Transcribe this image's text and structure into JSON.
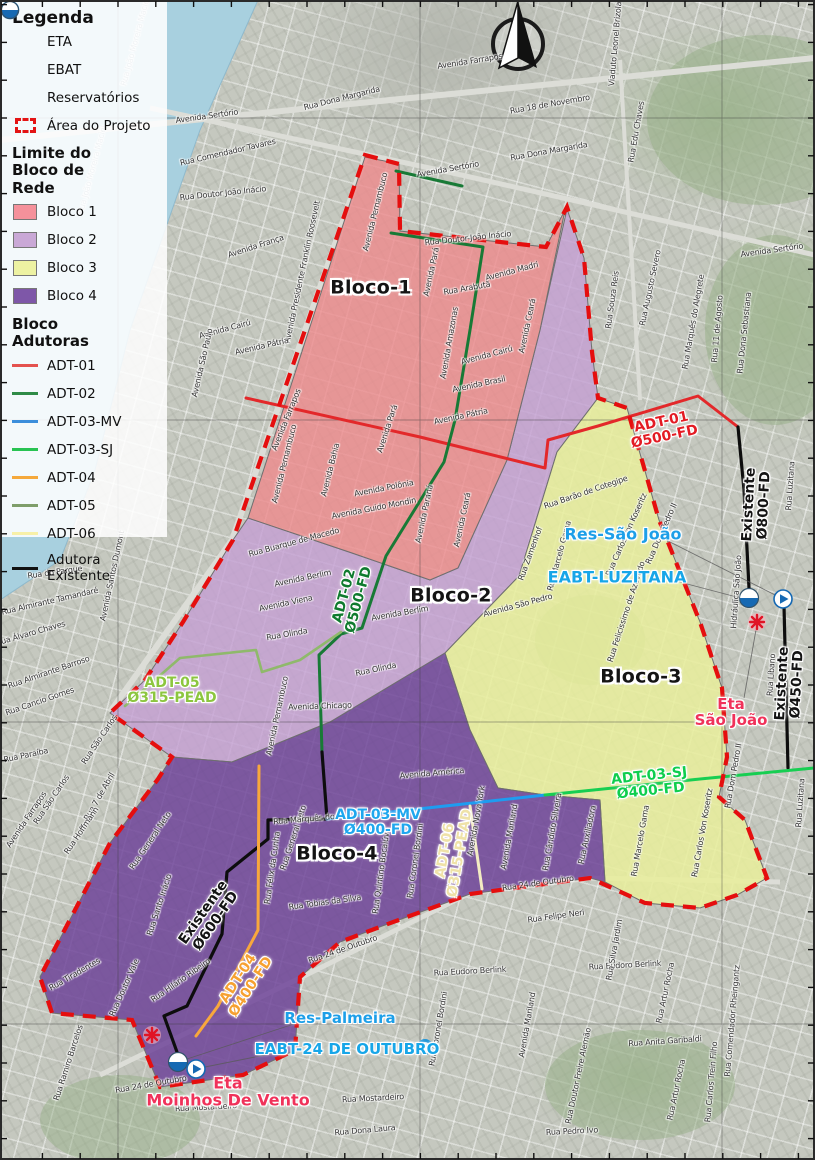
{
  "legend": {
    "title": "Legenda",
    "items": [
      {
        "label": "ETA"
      },
      {
        "label": "EBAT"
      },
      {
        "label": "Reservatórios"
      },
      {
        "label": "Área do Projeto"
      }
    ],
    "limite_title": "Limite do Bloco de Rede",
    "blocks": [
      {
        "label": "Bloco 1",
        "color": "#F5919B"
      },
      {
        "label": "Bloco 2",
        "color": "#C9A8D6"
      },
      {
        "label": "Bloco 3",
        "color": "#EDF2A2"
      },
      {
        "label": "Bloco 4",
        "color": "#7E57A8"
      }
    ],
    "adutoras_title": "Bloco Adutoras",
    "adutoras": [
      {
        "label": "ADT-01",
        "color": "#E4524E"
      },
      {
        "label": "ADT-02",
        "color": "#2E8B47"
      },
      {
        "label": "ADT-03-MV",
        "color": "#3B8EDB"
      },
      {
        "label": "ADT-03-SJ",
        "color": "#28C352"
      },
      {
        "label": "ADT-04",
        "color": "#F5A93B"
      },
      {
        "label": "ADT-05",
        "color": "#7E9E6A"
      },
      {
        "label": "ADT-06",
        "color": "#F7F0A8"
      },
      {
        "label": "Adutora Existente",
        "color": "#111111"
      }
    ]
  },
  "map": {
    "colors": {
      "water": "#A8D0DF",
      "bloco1": "#EE8A8C",
      "bloco2": "#C49FD3",
      "bloco3": "#E9EF9B",
      "bloco4": "#6B3F97",
      "project_boundary": "#E50E0E",
      "adt01": "#E3282A",
      "adt02": "#187A36",
      "adt03mv": "#1E9CF0",
      "adt03sj": "#17CE52",
      "adt04": "#F8A83C",
      "adt05": "#8FB96B",
      "adt06": "#F3ECC2",
      "existente": "#0D0D0D"
    },
    "block_labels": [
      {
        "t": "Bloco-1",
        "x": 371,
        "y": 288,
        "c": "#141414"
      },
      {
        "t": "Bloco-2",
        "x": 451,
        "y": 596,
        "c": "#141414"
      },
      {
        "t": "Bloco-3",
        "x": 641,
        "y": 677,
        "c": "#141414"
      },
      {
        "t": "Bloco-4",
        "x": 337,
        "y": 854,
        "c": "#141414"
      }
    ],
    "pipe_labels": [
      {
        "lines": [
          "ADT-01",
          "Ø500-FD"
        ],
        "x": 663,
        "y": 430,
        "r": -12,
        "c": "#E31B23"
      },
      {
        "lines": [
          "ADT-02",
          "Ø500-FD"
        ],
        "x": 352,
        "y": 598,
        "r": -75,
        "c": "#0F7A2E"
      },
      {
        "lines": [
          "ADT-03-MV",
          "Ø400-FD"
        ],
        "x": 378,
        "y": 823,
        "r": 0,
        "c": "#1FA7EE"
      },
      {
        "lines": [
          "ADT-03-SJ",
          "Ø400-FD"
        ],
        "x": 650,
        "y": 784,
        "r": -6,
        "c": "#0FCE4E"
      },
      {
        "lines": [
          "ADT-04",
          "Ø400-FD"
        ],
        "x": 245,
        "y": 983,
        "r": -57,
        "c": "#F6A131"
      },
      {
        "lines": [
          "ADT-05",
          "Ø315-PEAD"
        ],
        "x": 172,
        "y": 691,
        "r": 0,
        "c": "#8CC63F"
      },
      {
        "lines": [
          "ADT-06",
          "Ø315-PEAD"
        ],
        "x": 453,
        "y": 852,
        "r": -80,
        "c": "#EFE2A8"
      },
      {
        "lines": [
          "Existente",
          "Ø800-FD"
        ],
        "x": 757,
        "y": 505,
        "r": -87,
        "c": "#141414"
      },
      {
        "lines": [
          "Existente",
          "Ø450-FD"
        ],
        "x": 790,
        "y": 684,
        "r": -87,
        "c": "#141414"
      },
      {
        "lines": [
          "Existente",
          "Ø600-FD"
        ],
        "x": 210,
        "y": 917,
        "r": -55,
        "c": "#141414"
      }
    ],
    "facility_labels": [
      {
        "t": "Res-São João",
        "x": 623,
        "y": 534,
        "c": "#1D9FE8",
        "fs": 16
      },
      {
        "t": "EABT-LUZITANA",
        "x": 617,
        "y": 577,
        "c": "#17A6E8",
        "fs": 16
      },
      {
        "lines": [
          "Eta",
          "São João"
        ],
        "x": 731,
        "y": 712,
        "c": "#F0325A",
        "fs": 15
      },
      {
        "t": "Res-Palmeira",
        "x": 340,
        "y": 1018,
        "c": "#1D9FE8",
        "fs": 15
      },
      {
        "t": "EABT-24 DE OUTUBRO",
        "x": 347,
        "y": 1049,
        "c": "#17A6E8",
        "fs": 15
      },
      {
        "lines": [
          "Eta",
          "Moinhos De Vento"
        ],
        "x": 228,
        "y": 1092,
        "c": "#F0325A",
        "fs": 16
      }
    ],
    "street_labels": [
      {
        "t": "Rua João Moreira Maciel",
        "x": 136,
        "y": 42,
        "r": -75,
        "c": "#93a6b2"
      },
      {
        "t": "Rua João Moreira Maciel",
        "x": 93,
        "y": 170,
        "r": -75,
        "c": "#93a6b2"
      },
      {
        "t": "Avenida Farrapos",
        "x": 470,
        "y": 62,
        "r": -9
      },
      {
        "t": "Rua Dona Margarida",
        "x": 342,
        "y": 99,
        "r": -14
      },
      {
        "t": "Rua 18 de Novembro",
        "x": 550,
        "y": 105,
        "r": -10
      },
      {
        "t": "Rua Dona Margarida",
        "x": 549,
        "y": 152,
        "r": -10
      },
      {
        "t": "Viaduto Leonel Brizola",
        "x": 616,
        "y": 44,
        "r": -85
      },
      {
        "t": "Rua Edu Chaves",
        "x": 637,
        "y": 132,
        "r": -80
      },
      {
        "t": "Avenida Sertório",
        "x": 207,
        "y": 117,
        "r": -8
      },
      {
        "t": "Rua Comendador Tavares",
        "x": 228,
        "y": 153,
        "r": -13
      },
      {
        "t": "Rua Doutor João Inácio",
        "x": 223,
        "y": 194,
        "r": -6
      },
      {
        "t": "Avenida França",
        "x": 256,
        "y": 247,
        "r": -18
      },
      {
        "t": "Avenida Presidente Franklin Roosevelt",
        "x": 303,
        "y": 272,
        "r": -78
      },
      {
        "t": "Avenida Cairú",
        "x": 225,
        "y": 330,
        "r": -15
      },
      {
        "t": "Avenida São Paulo",
        "x": 203,
        "y": 363,
        "r": -77
      },
      {
        "t": "Avenida Pátria",
        "x": 262,
        "y": 347,
        "r": -13
      },
      {
        "t": "Avenida Sertório",
        "x": 448,
        "y": 170,
        "r": -10
      },
      {
        "t": "Avenida Sertório",
        "x": 772,
        "y": 251,
        "r": -8
      },
      {
        "t": "Rua Souza Reis",
        "x": 613,
        "y": 300,
        "r": -82
      },
      {
        "t": "Rua Augusto Severo",
        "x": 651,
        "y": 288,
        "r": -78
      },
      {
        "t": "Rua Marquês do Alegrete",
        "x": 694,
        "y": 322,
        "r": -80
      },
      {
        "t": "Rua 11 de Agosto",
        "x": 718,
        "y": 329,
        "r": -85
      },
      {
        "t": "Rua Dona Sebastiana",
        "x": 745,
        "y": 333,
        "r": -84
      },
      {
        "t": "Rua Luzitana",
        "x": 791,
        "y": 486,
        "r": -86
      },
      {
        "t": "Rua Luzitana",
        "x": 801,
        "y": 803,
        "r": -86
      },
      {
        "t": "Rua Doutor João Inácio",
        "x": 468,
        "y": 239,
        "r": -6
      },
      {
        "t": "Avenida Madri",
        "x": 512,
        "y": 272,
        "r": -15
      },
      {
        "t": "Rua Arabutã",
        "x": 467,
        "y": 289,
        "r": -10
      },
      {
        "t": "Avenida Pará",
        "x": 432,
        "y": 272,
        "r": -78
      },
      {
        "t": "Avenida Pernambuco",
        "x": 376,
        "y": 212,
        "r": -76
      },
      {
        "t": "Avenida Amazonas",
        "x": 450,
        "y": 343,
        "r": -80
      },
      {
        "t": "Avenida Cairú",
        "x": 487,
        "y": 356,
        "r": -15
      },
      {
        "t": "Avenida Brasil",
        "x": 479,
        "y": 385,
        "r": -12
      },
      {
        "t": "Avenida Ceará",
        "x": 528,
        "y": 326,
        "r": -78
      },
      {
        "t": "Avenida Pátria",
        "x": 461,
        "y": 417,
        "r": -12
      },
      {
        "t": "Avenida Pará",
        "x": 388,
        "y": 429,
        "r": -72
      },
      {
        "t": "Avenida Pernambuco",
        "x": 285,
        "y": 464,
        "r": -76
      },
      {
        "t": "Avenida Bahia",
        "x": 331,
        "y": 470,
        "r": -76
      },
      {
        "t": "Avenida Polônia",
        "x": 384,
        "y": 489,
        "r": -11
      },
      {
        "t": "Avenida Guido Mondin",
        "x": 374,
        "y": 509,
        "r": -11
      },
      {
        "t": "Avenida Paraná",
        "x": 425,
        "y": 514,
        "r": -78
      },
      {
        "t": "Avenida Ceará",
        "x": 463,
        "y": 520,
        "r": -78
      },
      {
        "t": "Avenida Farrapos",
        "x": 287,
        "y": 420,
        "r": -68
      },
      {
        "t": "Rua Buarque de Macedo",
        "x": 294,
        "y": 543,
        "r": -15
      },
      {
        "t": "Avenida Berlim",
        "x": 303,
        "y": 579,
        "r": -12
      },
      {
        "t": "Avenida Berlim",
        "x": 400,
        "y": 614,
        "r": -10
      },
      {
        "t": "Avenida Viena",
        "x": 286,
        "y": 604,
        "r": -12
      },
      {
        "t": "Rua Olinda",
        "x": 287,
        "y": 635,
        "r": -10
      },
      {
        "t": "Rua Olinda",
        "x": 376,
        "y": 670,
        "r": -12
      },
      {
        "t": "Avenida Chicago",
        "x": 320,
        "y": 707,
        "r": -2
      },
      {
        "t": "Avenida Pernambuco",
        "x": 278,
        "y": 716,
        "r": -78
      },
      {
        "t": "Rua Barão de Cotegipe",
        "x": 586,
        "y": 493,
        "r": -19
      },
      {
        "t": "Rua Carlos Von Koseritz",
        "x": 627,
        "y": 535,
        "r": -66
      },
      {
        "t": "Rua Carlos Von Koseritz",
        "x": 703,
        "y": 833,
        "r": -80
      },
      {
        "t": "Rua Felicissimo de Azevedo",
        "x": 627,
        "y": 612,
        "r": -72
      },
      {
        "t": "Rua Zamenhof",
        "x": 531,
        "y": 554,
        "r": -70
      },
      {
        "t": "Avenida São Pedro",
        "x": 518,
        "y": 606,
        "r": -15
      },
      {
        "t": "Rua Marcelo Gama",
        "x": 560,
        "y": 556,
        "r": -75
      },
      {
        "t": "Rua Marcelo Gama",
        "x": 641,
        "y": 841,
        "r": -80
      },
      {
        "t": "Rua Dom Pedro II",
        "x": 662,
        "y": 534,
        "r": -66
      },
      {
        "t": "Rua Dom Pedro II",
        "x": 734,
        "y": 776,
        "r": -80
      },
      {
        "t": "Rua Auxiliadora",
        "x": 588,
        "y": 835,
        "r": -78
      },
      {
        "t": "Hidráulica São João",
        "x": 737,
        "y": 592,
        "r": -86
      },
      {
        "t": "Rua Líbano",
        "x": 772,
        "y": 675,
        "r": -86
      },
      {
        "t": "Rua do Parque",
        "x": 55,
        "y": 573,
        "r": -8
      },
      {
        "t": "Avenida Santos Dumont",
        "x": 113,
        "y": 576,
        "r": -78
      },
      {
        "t": "Rua Almirante Tamandaré",
        "x": 50,
        "y": 602,
        "r": -13
      },
      {
        "t": "Rua Álvaro Chaves",
        "x": 31,
        "y": 634,
        "r": -16
      },
      {
        "t": "Rua Almirante Barroso",
        "x": 49,
        "y": 673,
        "r": -19
      },
      {
        "t": "Rua Cancio Gomes",
        "x": 40,
        "y": 702,
        "r": -19
      },
      {
        "t": "Rua Paraíba",
        "x": 26,
        "y": 756,
        "r": -12
      },
      {
        "t": "Rua São Carlos",
        "x": 100,
        "y": 740,
        "r": -56
      },
      {
        "t": "Rua São Carlos",
        "x": 52,
        "y": 800,
        "r": -56
      },
      {
        "t": "Rua 7 de Abril",
        "x": 100,
        "y": 797,
        "r": -60
      },
      {
        "t": "Rua Hoffmann",
        "x": 82,
        "y": 831,
        "r": -56
      },
      {
        "t": "Avenida Farrapos",
        "x": 27,
        "y": 820,
        "r": -56
      },
      {
        "t": "Rua General Neto",
        "x": 151,
        "y": 841,
        "r": -56
      },
      {
        "t": "Rua General Neto",
        "x": 294,
        "y": 838,
        "r": -72
      },
      {
        "t": "Rua Santo Inácio",
        "x": 160,
        "y": 905,
        "r": -72
      },
      {
        "t": "Rua Hilário Ribeiro",
        "x": 181,
        "y": 981,
        "r": -35
      },
      {
        "t": "Rua Doutor Vale",
        "x": 125,
        "y": 988,
        "r": -66
      },
      {
        "t": "Rua Tiradentes",
        "x": 75,
        "y": 975,
        "r": -30
      },
      {
        "t": "Rua Ramiro Barcelos",
        "x": 69,
        "y": 1063,
        "r": -72
      },
      {
        "t": "Rua Félix da Cunha",
        "x": 273,
        "y": 868,
        "r": -82
      },
      {
        "t": "Rua Marquês do",
        "x": 304,
        "y": 820,
        "r": -5
      },
      {
        "t": "Rua Tobias da Silva",
        "x": 325,
        "y": 903,
        "r": -8
      },
      {
        "t": "Rua Quintino Bocaiúva",
        "x": 382,
        "y": 871,
        "r": -82
      },
      {
        "t": "Rua Coronel Bordini",
        "x": 416,
        "y": 861,
        "r": -82
      },
      {
        "t": "Avenida Nova York",
        "x": 477,
        "y": 821,
        "r": -80
      },
      {
        "t": "Avenida Mariland",
        "x": 510,
        "y": 837,
        "r": -80
      },
      {
        "t": "Avenida América",
        "x": 432,
        "y": 774,
        "r": -5
      },
      {
        "t": "Rua Cândido Silveira",
        "x": 553,
        "y": 832,
        "r": -80
      },
      {
        "t": "Rua 24 de Outubro",
        "x": 343,
        "y": 950,
        "r": -19
      },
      {
        "t": "Rua 24 de Outubro",
        "x": 538,
        "y": 884,
        "r": -8
      },
      {
        "t": "Rua 24 de Outubro",
        "x": 151,
        "y": 1085,
        "r": -10
      },
      {
        "t": "Rua Felipe Neri",
        "x": 556,
        "y": 917,
        "r": -8
      },
      {
        "t": "Rua Eudoro Berlink",
        "x": 470,
        "y": 972,
        "r": -3
      },
      {
        "t": "Rua Eudoro Berlink",
        "x": 625,
        "y": 966,
        "r": -3
      },
      {
        "t": "Rua Silva Jardim",
        "x": 615,
        "y": 950,
        "r": -80
      },
      {
        "t": "Rua Anita Garibaldi",
        "x": 665,
        "y": 1042,
        "r": -4
      },
      {
        "t": "Rua Artur Rocha",
        "x": 666,
        "y": 993,
        "r": -78
      },
      {
        "t": "Rua Artur Rocha",
        "x": 677,
        "y": 1090,
        "r": -78
      },
      {
        "t": "Rua Carlos Trein Filho",
        "x": 712,
        "y": 1082,
        "r": -85
      },
      {
        "t": "Rua Comendador Rheingantz",
        "x": 733,
        "y": 1021,
        "r": -85
      },
      {
        "t": "Rua Doutor Freire Alemão",
        "x": 579,
        "y": 1076,
        "r": -78
      },
      {
        "t": "Rua Pedro Ivo",
        "x": 572,
        "y": 1132,
        "r": -3
      },
      {
        "t": "Rua Mostardeiro",
        "x": 206,
        "y": 1108,
        "r": -3
      },
      {
        "t": "Rua Mostardeiro",
        "x": 373,
        "y": 1099,
        "r": -3
      },
      {
        "t": "Rua Dona Laura",
        "x": 365,
        "y": 1131,
        "r": -5
      },
      {
        "t": "Avenida Mariland",
        "x": 528,
        "y": 1025,
        "r": -80
      },
      {
        "t": "Rua Coronel Bordini",
        "x": 439,
        "y": 1029,
        "r": -80
      }
    ]
  }
}
